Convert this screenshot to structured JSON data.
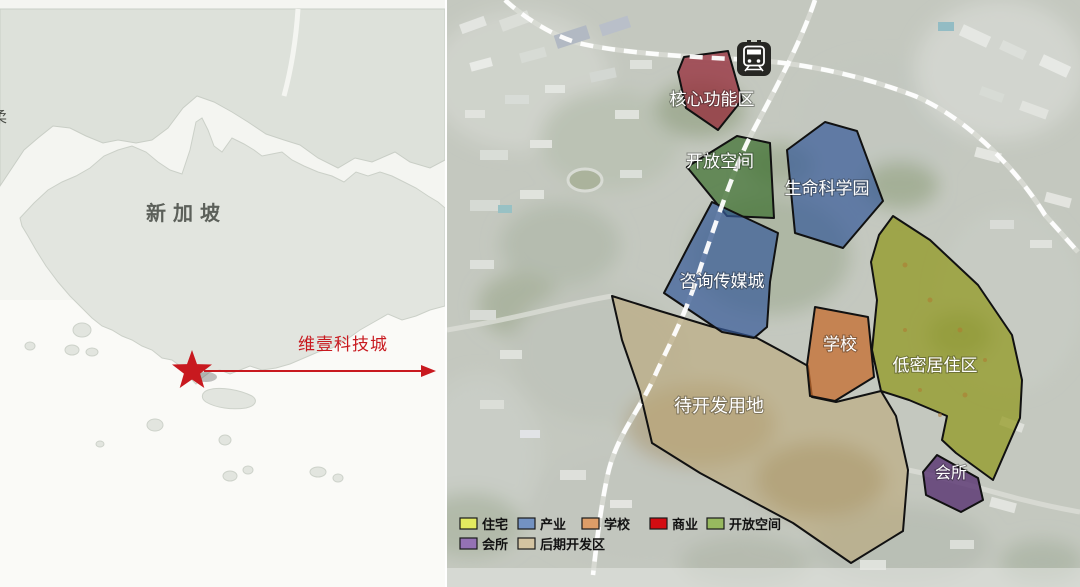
{
  "locator_map": {
    "country_label": "新加坡",
    "clipped_edge_label": "柔",
    "callout_label": "维壹科技城",
    "accent_color": "#c8191f"
  },
  "master_plan": {
    "station_icon": "metro-train-station",
    "zones": [
      {
        "label": "核心功能区",
        "fill": "rgba(148,38,52,0.72)"
      },
      {
        "label": "开放空间",
        "fill": "rgba(62,112,48,0.72)"
      },
      {
        "label": "生命科学园",
        "fill": "rgba(54,90,152,0.70)"
      },
      {
        "label": "咨询传媒城",
        "fill": "rgba(54,90,152,0.70)"
      },
      {
        "label": "学校",
        "fill": "rgba(198,108,46,0.75)"
      },
      {
        "label": "低密居住区",
        "fill": "rgba(142,150,24,0.70)"
      },
      {
        "label": "待开发用地",
        "fill": "rgba(188,166,114,0.55)"
      },
      {
        "label": "会所",
        "fill": "rgba(88,50,112,0.80)"
      }
    ],
    "legend": {
      "items": [
        {
          "label": "住宅",
          "color": "#e3ea60"
        },
        {
          "label": "产业",
          "color": "#7392c2"
        },
        {
          "label": "学校",
          "color": "#dd9d68"
        },
        {
          "label": "商业",
          "color": "#d30c12"
        },
        {
          "label": "开放空间",
          "color": "#97b95f"
        },
        {
          "label": "会所",
          "color": "#9472b4"
        },
        {
          "label": "后期开发区",
          "color": "#d3c3a1"
        }
      ]
    }
  }
}
